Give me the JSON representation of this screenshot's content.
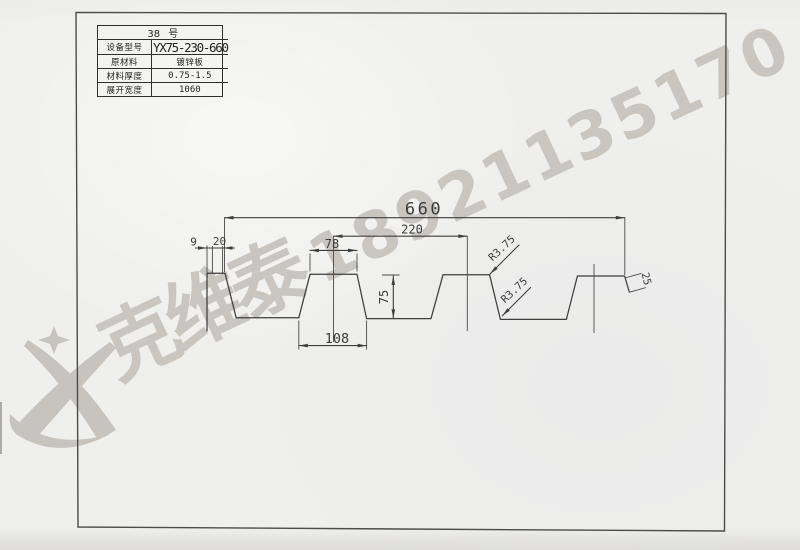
{
  "table": {
    "title": "38 号",
    "rows": [
      {
        "label": "设备型号",
        "value": "YX75-230-660"
      },
      {
        "label": "原材料",
        "value": "镀锌板"
      },
      {
        "label": "材料厚度",
        "value": "0.75-1.5"
      },
      {
        "label": "展开宽度",
        "value": "1060"
      }
    ]
  },
  "drawing": {
    "profile_name": "YX75-230-660",
    "dims": {
      "overall_width": "660",
      "rib_pitch": "220",
      "pan_top_width": "78",
      "rib_bottom_gap": "108",
      "profile_height": "75",
      "left_lip_a": "9",
      "left_lip_b": "20",
      "edge_tab": "25",
      "radius_top": "R3.75",
      "radius_bottom": "R3.75"
    }
  },
  "watermark": {
    "company": "克维泰",
    "phone": "18921135170"
  },
  "colors": {
    "paper": "#efefed",
    "line": "#3e3e3e",
    "watermark": "#c9c6c2"
  }
}
